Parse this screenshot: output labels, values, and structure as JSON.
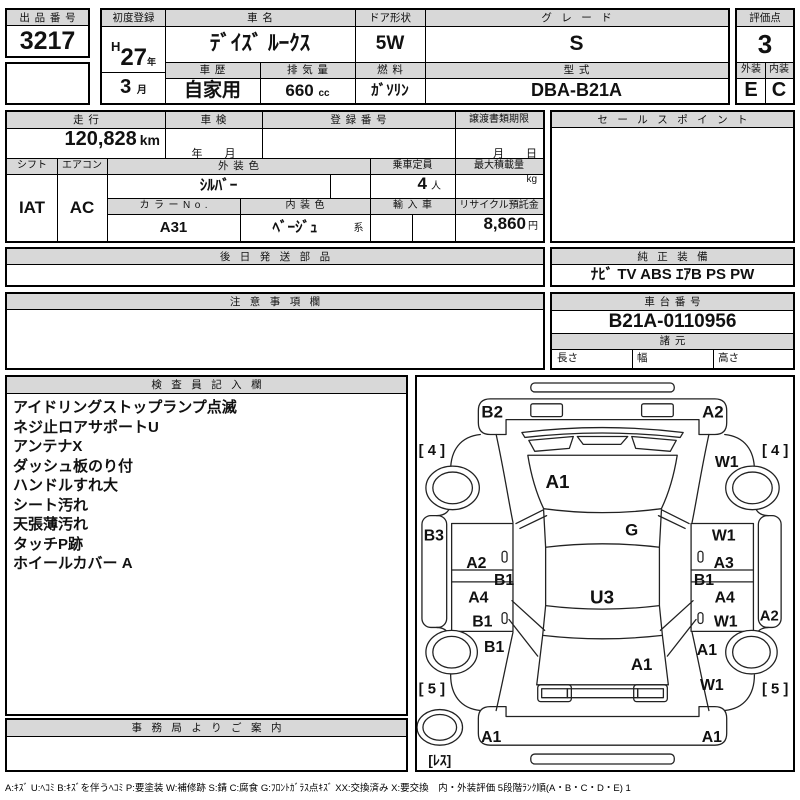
{
  "top": {
    "auction_no_label": "出品番号",
    "auction_no": "3217",
    "first_reg_label": "初度登録",
    "reg_era": "H",
    "reg_year": "27",
    "reg_year_unit": "年",
    "reg_month": "3",
    "reg_month_unit": "月",
    "car_name_label": "車名",
    "car_name": "ﾃﾞｲｽﾞ ﾙｰｸｽ",
    "history_label": "車歴",
    "history": "自家用",
    "displacement_label": "排気量",
    "displacement": "660",
    "displacement_unit": "cc",
    "door_label": "ドア形状",
    "door": "5W",
    "fuel_label": "燃料",
    "fuel": "ｶﾞｿﾘﾝ",
    "grade_label": "グレード",
    "grade": "S",
    "model_label": "型式",
    "model": "DBA-B21A",
    "score_label": "評価点",
    "score": "3",
    "exterior_label": "外装",
    "exterior": "E",
    "interior_label": "内装",
    "interior": "C"
  },
  "mid": {
    "mileage_label": "走行",
    "mileage": "120,828",
    "mileage_unit": "km",
    "inspection_label": "車検",
    "inspection_placeholder": "年　　月",
    "reg_no_label": "登録番号",
    "deadline_label": "譲渡書類期限",
    "deadline_placeholder": "月　　日",
    "sales_label": "セールスポイント",
    "shift_label": "シフト",
    "shift": "IAT",
    "aircon_label": "エアコン",
    "aircon": "AC",
    "ext_color_label": "外装色",
    "ext_color": "ｼﾙﾊﾞｰ",
    "capacity_label": "乗車定員",
    "capacity": "4",
    "capacity_unit": "人",
    "load_label": "最大積載量",
    "load_unit": "kg",
    "color_no_label": "カラーNo.",
    "color_no": "A31",
    "int_color_label": "内装色",
    "int_color": "ﾍﾞｰｼﾞｭ",
    "int_color_suffix": "系",
    "import_label": "輸入車",
    "recycle_label": "リサイクル預託金",
    "recycle": "8,860",
    "recycle_unit": "円"
  },
  "sections": {
    "later_parts_label": "後日発送部品",
    "equipment_label": "純正装備",
    "equipment": "ﾅﾋﾞ TV ABS ｴｱB PS PW",
    "caution_label": "注意事項欄",
    "chassis_label": "車台番号",
    "chassis_no": "B21A-0110956",
    "specs_label": "諸元",
    "spec_length": "長さ",
    "spec_width": "幅",
    "spec_height": "高さ",
    "inspector_label": "検査員記入欄",
    "inspector_notes": [
      "アイドリングストップランプ点滅",
      "ネジ止ロアサポートU",
      "アンテナX",
      "ダッシュ板のり付",
      "ハンドルすれ大",
      "シート汚れ",
      "天張薄汚れ",
      "タッチP跡",
      "ホイールカバー A"
    ],
    "office_label": "事務局よりご案内"
  },
  "diagram": {
    "labels": [
      {
        "name": "front-bumper-left",
        "text": "B2"
      },
      {
        "name": "front-bumper-right",
        "text": "A2"
      },
      {
        "name": "front-tire-left",
        "text": "[ 4 ]"
      },
      {
        "name": "front-tire-right",
        "text": "[ 4 ]"
      },
      {
        "name": "front-fender-right",
        "text": "W1"
      },
      {
        "name": "hood",
        "text": "A1"
      },
      {
        "name": "windshield",
        "text": "G"
      },
      {
        "name": "left-sill",
        "text": "B3"
      },
      {
        "name": "right-front-door-top",
        "text": "W1"
      },
      {
        "name": "left-front-door",
        "text": "A2"
      },
      {
        "name": "right-front-door",
        "text": "A3"
      },
      {
        "name": "left-pillar",
        "text": "B1"
      },
      {
        "name": "right-pillar",
        "text": "B1"
      },
      {
        "name": "left-rear-door",
        "text": "A4"
      },
      {
        "name": "roof",
        "text": "U3"
      },
      {
        "name": "right-rear-door",
        "text": "A4"
      },
      {
        "name": "left-rear-door-low",
        "text": "B1"
      },
      {
        "name": "right-rear-door-low",
        "text": "W1"
      },
      {
        "name": "right-sill",
        "text": "A2"
      },
      {
        "name": "left-quarter",
        "text": "B1"
      },
      {
        "name": "right-quarter",
        "text": "A1"
      },
      {
        "name": "tailgate",
        "text": "A1"
      },
      {
        "name": "right-rear-lower",
        "text": "W1"
      },
      {
        "name": "rear-tire-left",
        "text": "[ 5 ]"
      },
      {
        "name": "rear-tire-right",
        "text": "[ 5 ]"
      },
      {
        "name": "rear-bumper-left",
        "text": "A1"
      },
      {
        "name": "rear-bumper-right",
        "text": "A1"
      },
      {
        "name": "spare-tire",
        "text": "[ﾚｽ]"
      }
    ]
  },
  "footer": {
    "legend": "A:ｷｽﾞ U:ﾍｺﾐ B:ｷｽﾞを伴うﾍｺﾐ P:要塗装 W:補修跡 S:錆 C:腐食 G:ﾌﾛﾝﾄｶﾞﾗｽ点ｷｽﾞ XX:交換済み X:要交換　内・外装評価 5段階ﾗﾝｸ順(A・B・C・D・E) 1"
  },
  "colors": {
    "header_bg": "#d8d8d8",
    "border": "#000000",
    "text": "#111111"
  }
}
